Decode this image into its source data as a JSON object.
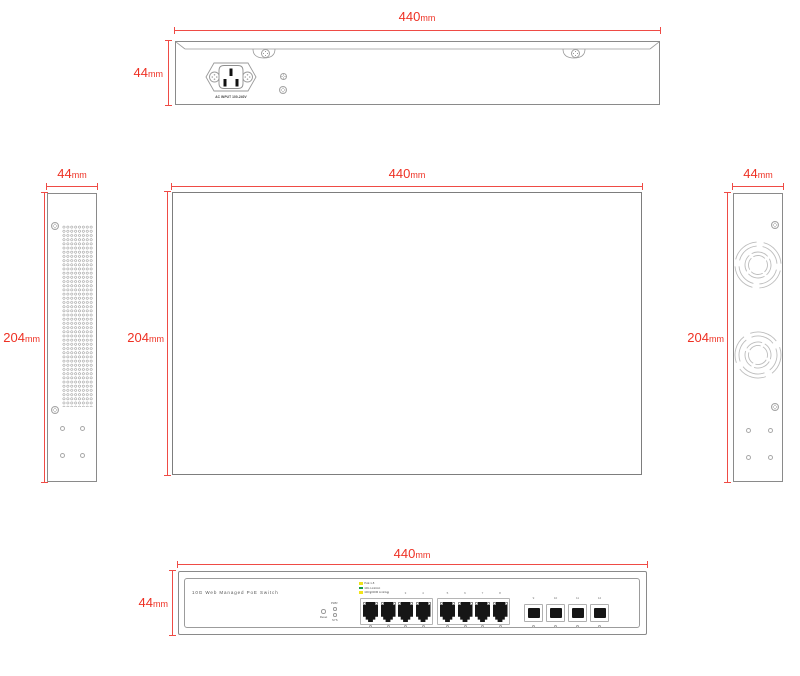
{
  "drawing_title": "PoE switch four-view dimensional drawing",
  "colors": {
    "dimension_red": "#ee3124",
    "outline_gray": "#8a8a8a",
    "detail_gray": "#b5b5b5",
    "port_black": "#161616",
    "legend_yellow": "#efe11b",
    "legend_green": "#169c46"
  },
  "dims": {
    "back_width": {
      "value": "440",
      "unit": "mm"
    },
    "back_height": {
      "value": "44",
      "unit": "mm"
    },
    "left_width": {
      "value": "44",
      "unit": "mm"
    },
    "left_height": {
      "value": "204",
      "unit": "mm"
    },
    "top_width": {
      "value": "440",
      "unit": "mm"
    },
    "top_height": {
      "value": "204",
      "unit": "mm"
    },
    "right_width": {
      "value": "44",
      "unit": "mm"
    },
    "right_height": {
      "value": "204",
      "unit": "mm"
    },
    "front_width": {
      "value": "440",
      "unit": "mm"
    },
    "front_height": {
      "value": "44",
      "unit": "mm"
    }
  },
  "back_view": {
    "ac_input_label": "AC INPUT 100-240V"
  },
  "front_view": {
    "product_label": "10G Web Managed PoE Switch",
    "legend": [
      {
        "color": "#efe11b",
        "label": "PoE 1-8"
      },
      {
        "color": "#169c46",
        "label": "10G Link/Act"
      },
      {
        "color": "#f3e418",
        "label": "100/1000M Link/Act"
      }
    ],
    "reset_label": "Reset",
    "pwr_label": "PWR",
    "sys_label": "SYS",
    "rj45_ports": [
      "1",
      "2",
      "3",
      "4",
      "5",
      "6",
      "7",
      "8"
    ],
    "sfp_ports": [
      "9",
      "10",
      "11",
      "12"
    ]
  }
}
